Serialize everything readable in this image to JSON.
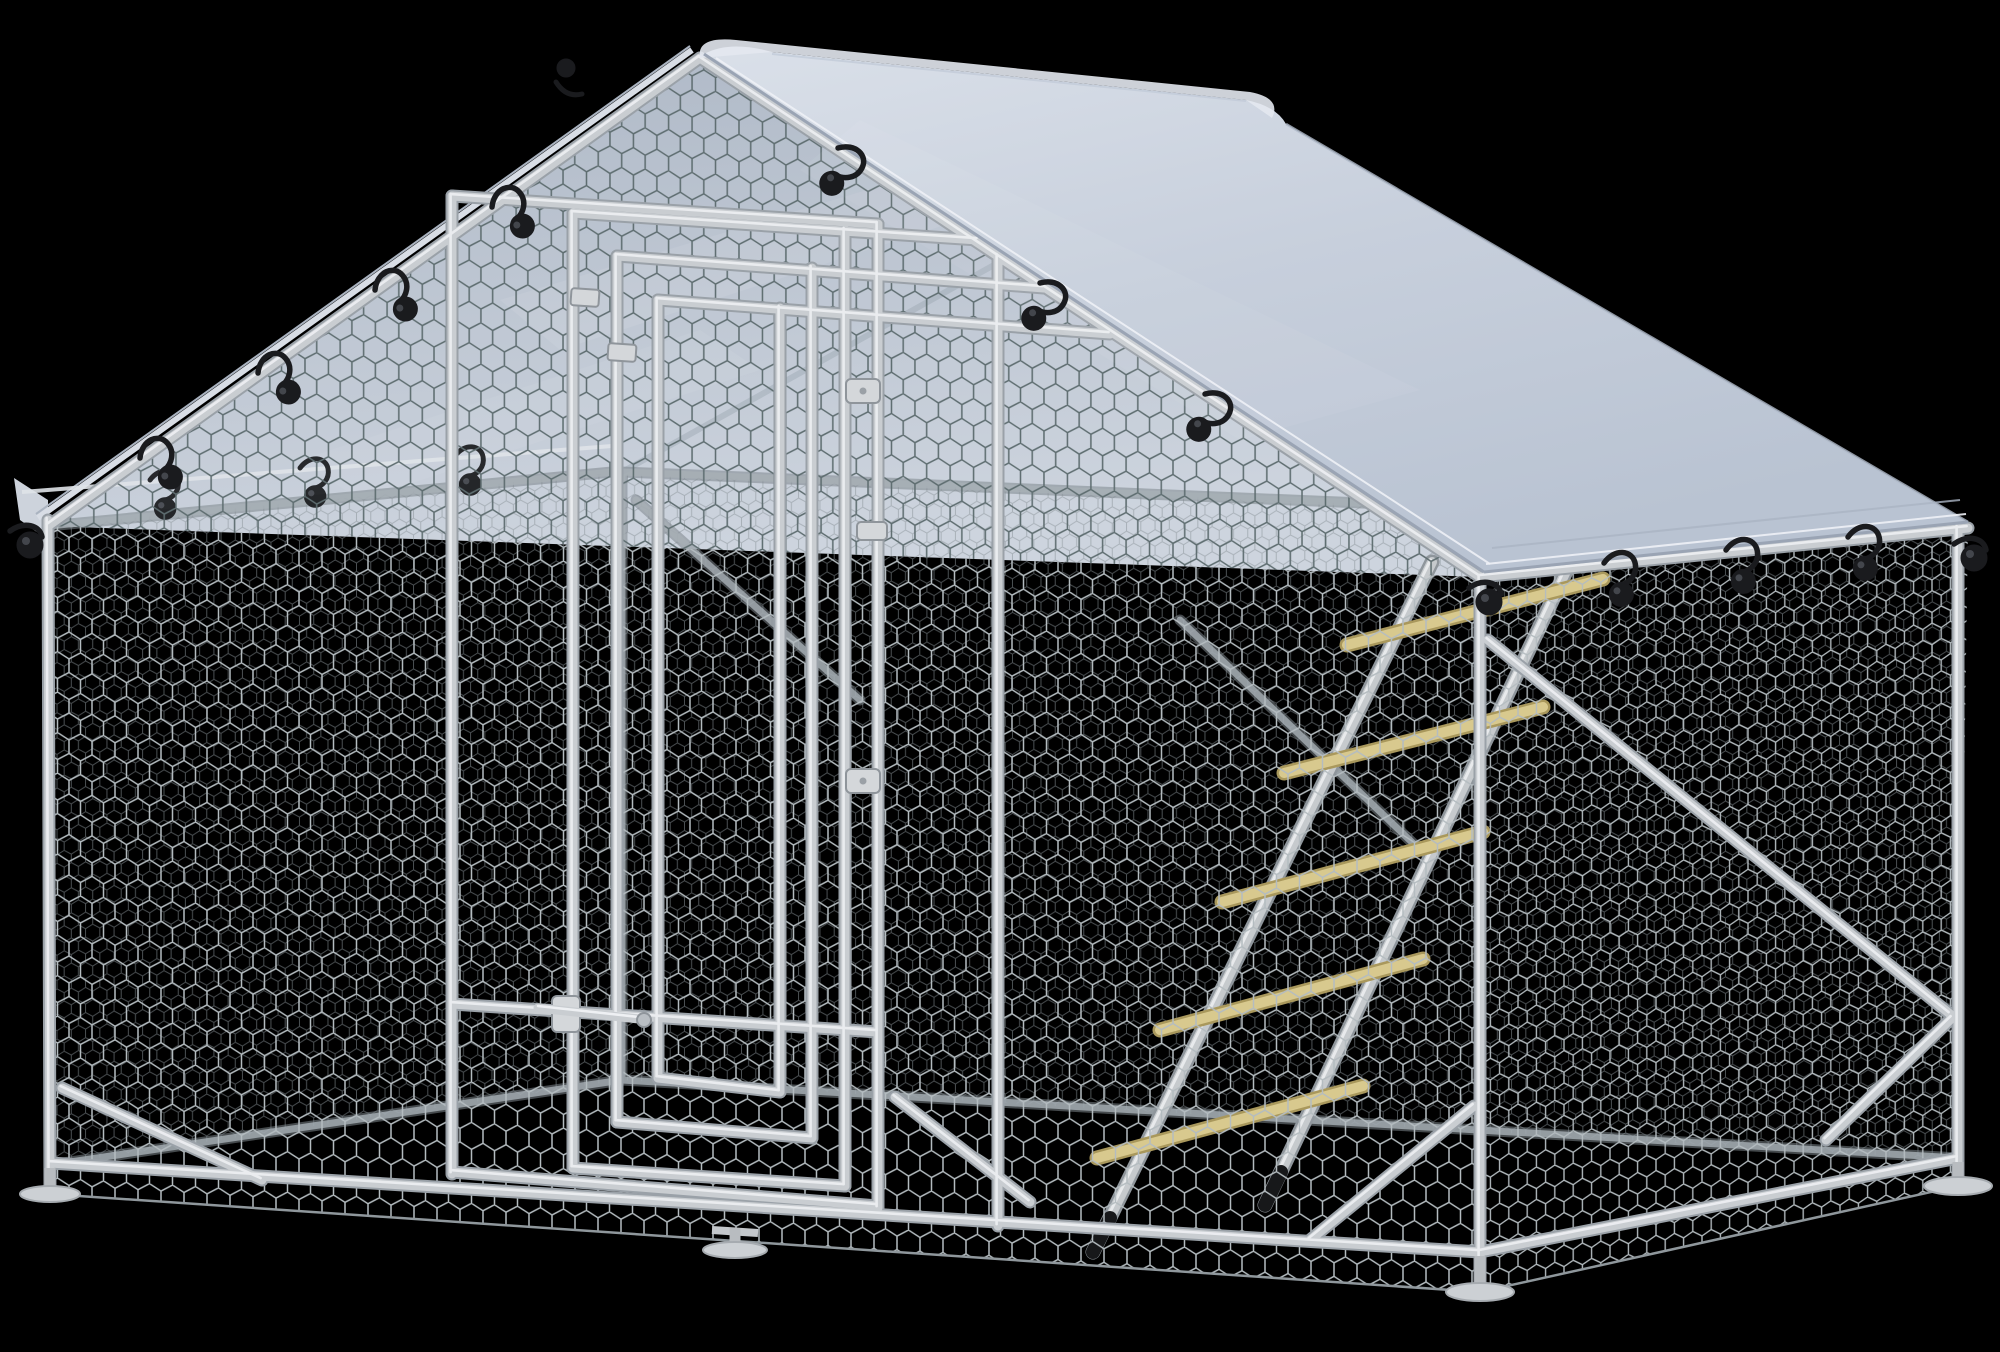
{
  "image": {
    "type": "product-render",
    "subject": "Walk-in galvanized metal chicken run with gable roof tarp cover, hexagonal wire mesh walls, front door and wooden perch ladder",
    "background": "#000000",
    "width": 2000,
    "height": 1352
  },
  "colors": {
    "background": "#000000",
    "frame_tube": "#c9cdd1",
    "frame_highlight": "#eef0f3",
    "frame_shadow": "#9aa1a8",
    "interior_frame": "#a8b0b6",
    "mesh_light": "#b4bcc0",
    "mesh_dark": "#5e6d70",
    "mesh_faint": "#8b9398",
    "tarp_light": "#dae0e9",
    "tarp_mid": "#c7cfdc",
    "tarp_deep": "#b9c3d2",
    "tarp_edge": "#9aa4b4",
    "tarp_hem_highlight": "#eef1f6",
    "tarp_underside_top": "#aeb8c6",
    "tarp_underside_bottom": "#cdd4de",
    "bungee_black": "#1a1b1e",
    "bungee_highlight": "#43464c",
    "rung_wood": "#d8c98e",
    "rung_wood_edge": "#a9985c",
    "foot_plate": "#ccd0d4",
    "foot_plate_edge": "#a6abb0"
  },
  "parts": {
    "roof_cover": "waterproof gable tarp cover",
    "bungee_hook_count": 16,
    "ladder_rung_count": 5,
    "foot_plate_count": 4,
    "door": "front walk-in door with nested tube frames, hinges and latch",
    "mesh": "hexagonal chicken wire on all walls and gable"
  }
}
